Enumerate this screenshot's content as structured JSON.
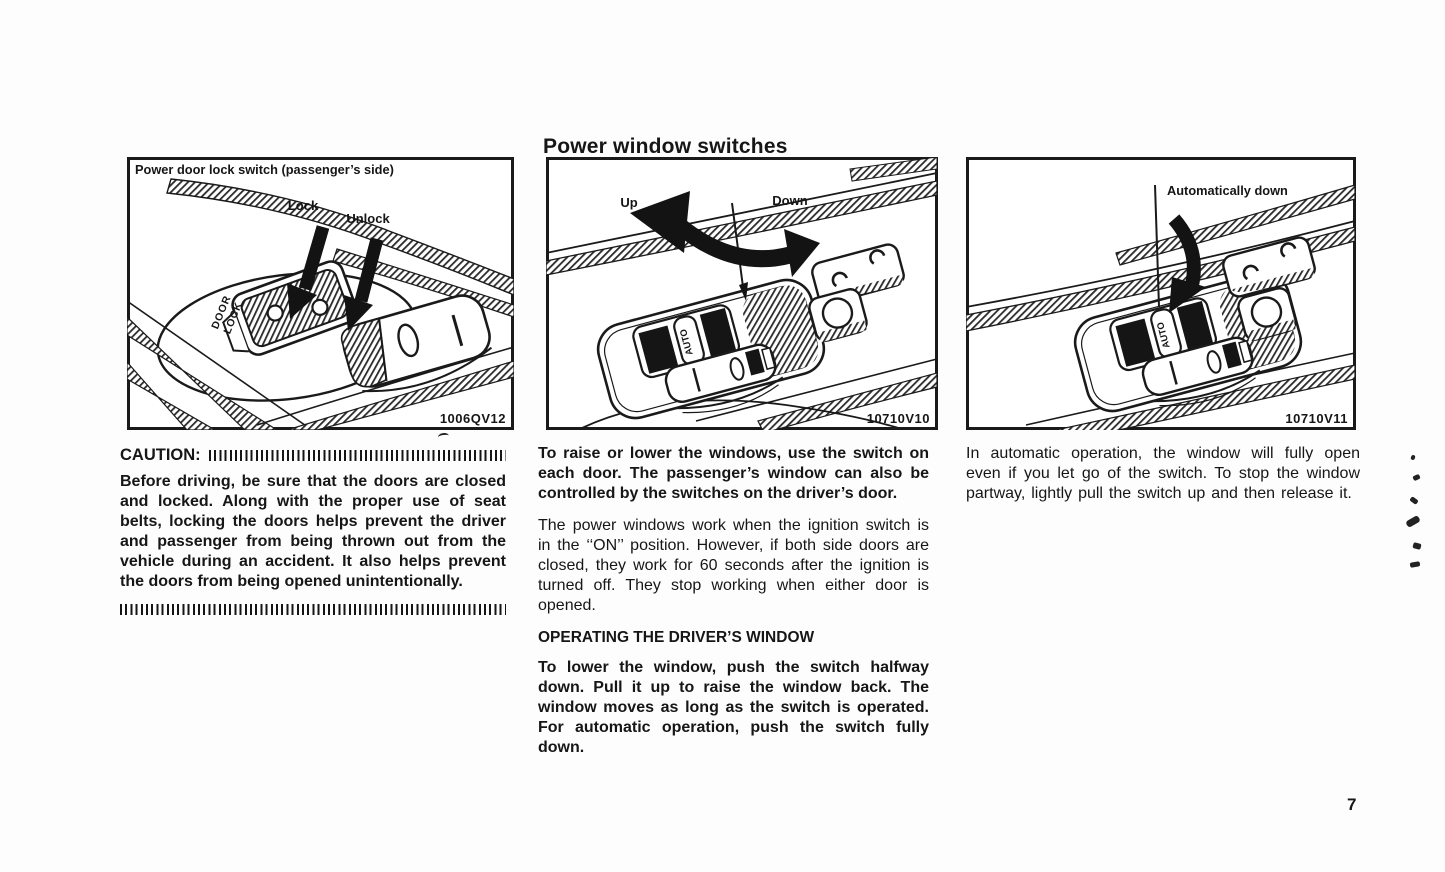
{
  "page": {
    "title": "Power window switches",
    "page_number": "7"
  },
  "figures": [
    {
      "caption": "Power door lock switch (passenger’s side)",
      "lock_label": "Lock",
      "unlock_label": "Unlock",
      "switch_line1": "DOOR",
      "switch_line2": "LOCK",
      "code": "1006QV12"
    },
    {
      "up_label": "Up",
      "down_label": "Down",
      "auto_label": "AUTO",
      "code": "10710V10"
    },
    {
      "label": "Automatically down",
      "auto_label": "AUTO",
      "code": "10710V11"
    }
  ],
  "columns": {
    "left": {
      "caution_heading": "CAUTION:",
      "caution_body": "Before driving, be sure that the doors are closed and locked. Along with the proper use of seat belts, locking the doors helps prevent the driver and passenger from being thrown out from the vehicle during an accident. It also helps prevent the doors from being opened unintentionally."
    },
    "middle": {
      "para1": "To raise or lower the windows, use the switch on each door. The passenger’s window can also be controlled by the switches on the driver’s door.",
      "para2": "The power windows work when the ignition switch is in the ‘‘ON’’ position. However, if both side doors are closed, they work for 60 seconds after the ignition is turned off. They stop working when either door is opened.",
      "heading": "OPERATING THE DRIVER’S WINDOW",
      "para3": "To lower the window, push the switch halfway down. Pull it up to raise the window back. The window moves as long as the switch is operated. For automatic operation, push the switch fully down."
    },
    "right": {
      "para1": "In automatic operation, the window will fully open even if you let go of the switch. To stop the window partway, lightly pull the switch up and then release it."
    }
  }
}
